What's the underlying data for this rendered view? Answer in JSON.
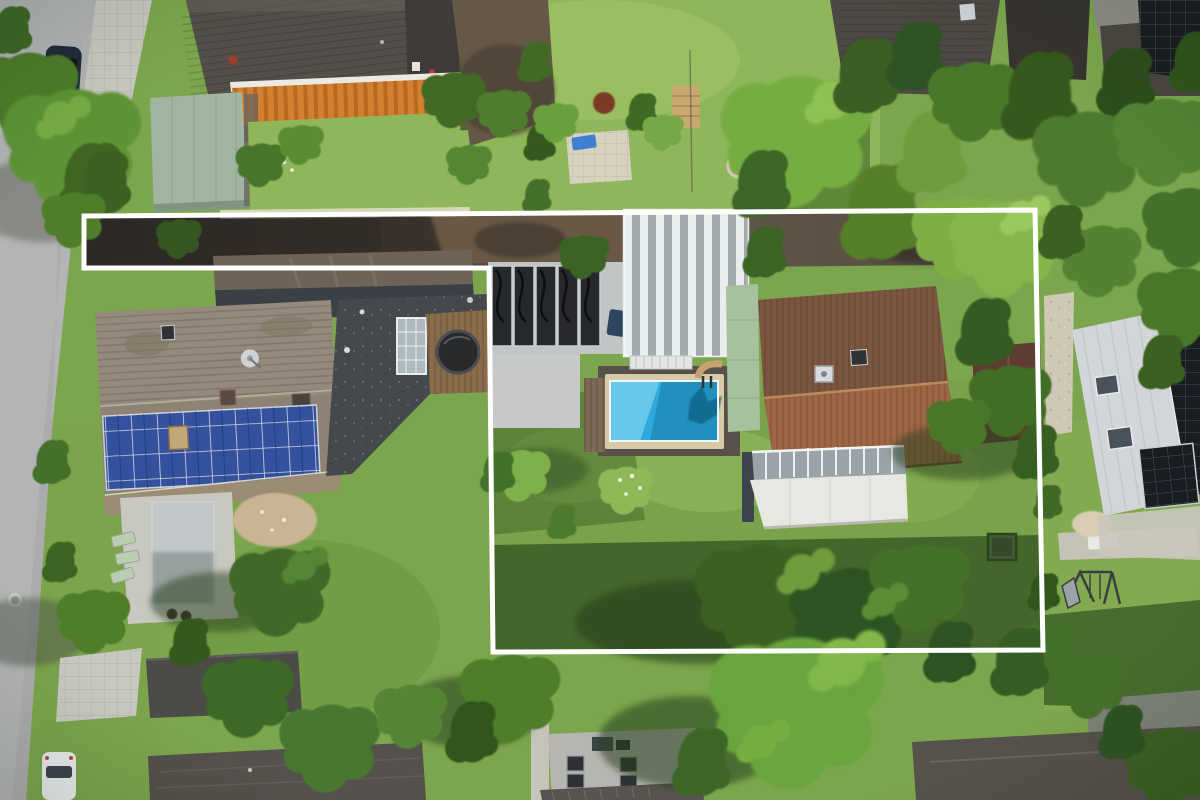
{
  "boundary": {
    "points": "84,216 1035,210 1043,650 493,652 489,268 84,268",
    "color": "#ffffff",
    "stroke_width": 5
  },
  "palette": {
    "lawn_base": "#7ca64d",
    "road": "#b3b4b6",
    "awning_orange": "#d2802f",
    "solar_blue": "#34519e",
    "solar_black": "#191c20",
    "pool_water": "#2fa9dd",
    "pool_light": "#8fdef7",
    "red_roof_upper": "#7a553f",
    "red_roof_lower": "#9d6746",
    "mint_wall": "#a6c19e",
    "driveway_dark": "#463e34",
    "conservatory_awning": "#e8e8e3",
    "carport_green": "#a2b5a2"
  }
}
